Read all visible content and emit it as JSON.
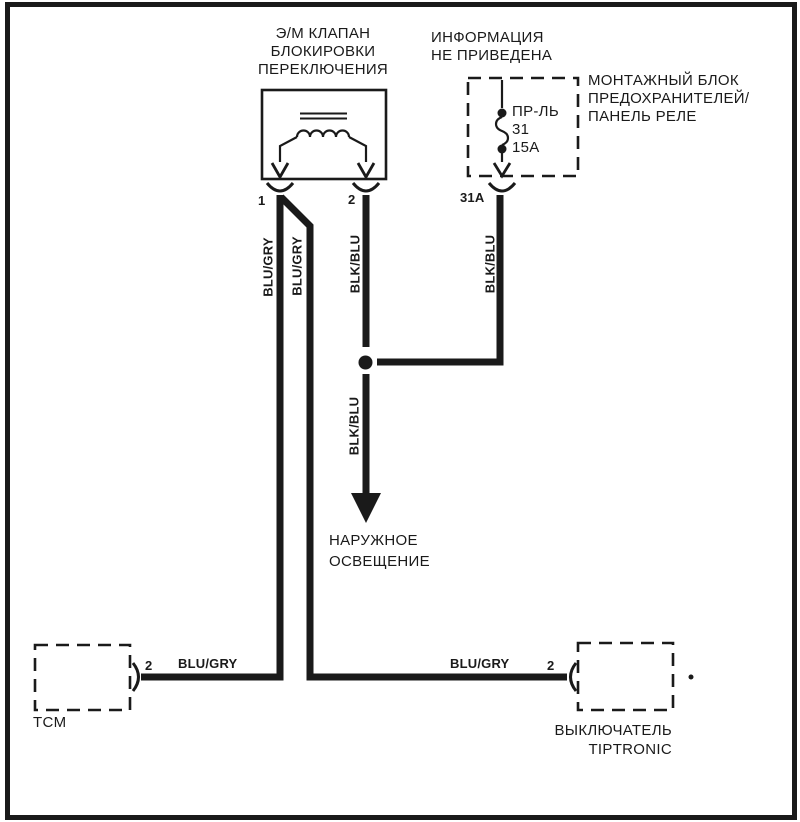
{
  "colors": {
    "line": "#1a1a1a",
    "background": "#ffffff"
  },
  "solenoid": {
    "title_lines": [
      "Э/М КЛАПАН",
      "БЛОКИРОВКИ",
      "ПЕРЕКЛЮЧЕНИЯ"
    ],
    "pin_left": "1",
    "pin_right": "2"
  },
  "fuse_panel": {
    "note_lines": [
      "ИНФОРМАЦИЯ",
      "НЕ ПРИВЕДЕНА"
    ],
    "name_lines": [
      "МОНТАЖНЫЙ БЛОК",
      "ПРЕДОХРАНИТЕЛЕЙ/",
      "ПАНЕЛЬ РЕЛЕ"
    ],
    "fuse_lines": [
      "ПР-ЛЬ",
      "31",
      "15А"
    ],
    "pin": "31A"
  },
  "wires": {
    "solenoid_pin1": "BLU/GRY",
    "solenoid_pin1_branch": "BLU/GRY",
    "solenoid_pin2": "BLK/BLU",
    "fuse_feed": "BLK/BLU",
    "lighting_feed": "BLK/BLU",
    "tcm": "BLU/GRY",
    "tiptronic": "BLU/GRY"
  },
  "exterior_lighting": {
    "label_lines": [
      "НАРУЖНОЕ",
      "ОСВЕЩЕНИЕ"
    ]
  },
  "tcm": {
    "label": "TCM",
    "pin": "2"
  },
  "tiptronic": {
    "label_lines": [
      "ВЫКЛЮЧАТЕЛЬ",
      "TIPTRONIC"
    ],
    "pin": "2"
  }
}
